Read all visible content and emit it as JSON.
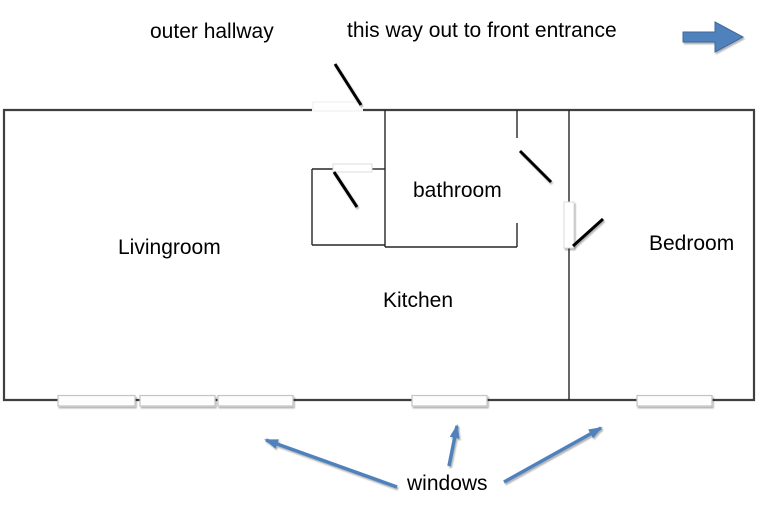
{
  "annotations": {
    "outer_hallway": "outer hallway",
    "front_entrance": "this way out to front entrance",
    "windows": "windows"
  },
  "rooms": {
    "livingroom": "Livingroom",
    "bathroom": "bathroom",
    "kitchen": "Kitchen",
    "bedroom": "Bedroom"
  },
  "features": {
    "window_count": 5,
    "door_count": 4
  },
  "colors": {
    "annotation_arrow_blue": "#4f81bd",
    "block_arrow_border": "#41699c",
    "outer_wall": "#3f3f3f",
    "inner_wall": "#262626",
    "door_line": "#000000"
  }
}
